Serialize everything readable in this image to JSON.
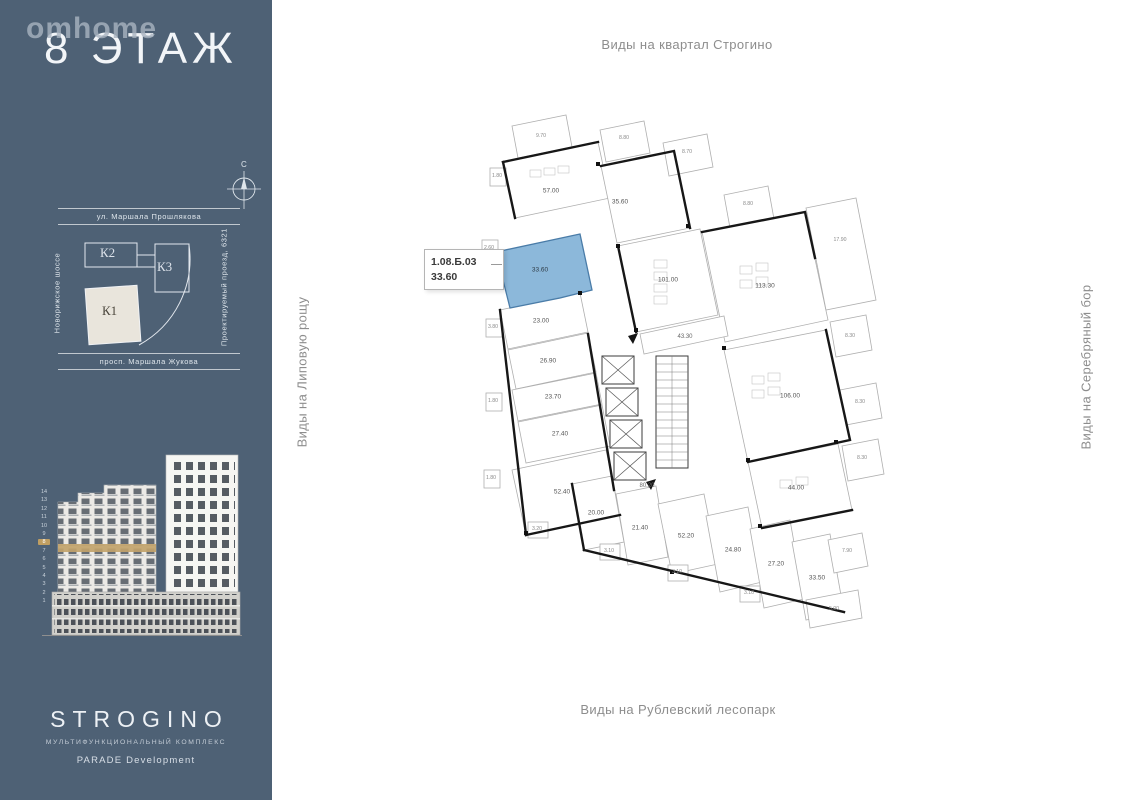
{
  "sidebar": {
    "logo": "omhome",
    "floor_title": "8 ЭТАЖ",
    "compass_north": "С",
    "site_map": {
      "street_top": "ул. Маршала Прошлякова",
      "street_left": "Новорижское шоссе",
      "street_right": "Проектируемый проезд, 6321",
      "street_bottom": "просп. Маршала Жукова",
      "buildings": [
        {
          "label": "К2",
          "highlighted": false
        },
        {
          "label": "К3",
          "highlighted": false
        },
        {
          "label": "К1",
          "highlighted": true
        }
      ]
    },
    "elevation_floors": [
      "14",
      "13",
      "12",
      "11",
      "10",
      "9",
      "8",
      "7",
      "6",
      "5",
      "4",
      "3",
      "2",
      "1"
    ],
    "highlighted_floor": "8",
    "brand": {
      "name": "STROGINO",
      "subtitle": "МУЛЬТИФУНКЦИОНАЛЬНЫЙ КОМПЛЕКС",
      "developer": "PARADE Development"
    }
  },
  "main": {
    "view_labels": {
      "top": "Виды на квартал Строгино",
      "bottom": "Виды на Рублевский лесопарк",
      "left": "Виды на Липовую рощу",
      "right": "Виды на Серебряный бор"
    },
    "callout": {
      "unit_id": "1.08.Б.03",
      "area": "33.60"
    },
    "colors": {
      "highlight": "#7FB0D6",
      "sidebar_bg": "#4E6175",
      "floor_marker": "#BF9E62"
    },
    "plan": {
      "rooms": [
        {
          "label": "57.00",
          "x": 111,
          "y": 101
        },
        {
          "label": "35.60",
          "x": 180,
          "y": 112
        },
        {
          "label": "101.00",
          "x": 228,
          "y": 190
        },
        {
          "label": "113.30",
          "x": 325,
          "y": 196
        },
        {
          "label": "106.00",
          "x": 350,
          "y": 306
        },
        {
          "label": "44.00",
          "x": 356,
          "y": 398
        },
        {
          "label": "33.60",
          "x": 100,
          "y": 180,
          "highlighted": true
        },
        {
          "label": "23.00",
          "x": 101,
          "y": 231
        },
        {
          "label": "26.90",
          "x": 108,
          "y": 271
        },
        {
          "label": "23.70",
          "x": 113,
          "y": 307
        },
        {
          "label": "27.40",
          "x": 120,
          "y": 344
        },
        {
          "label": "52.40",
          "x": 122,
          "y": 402
        },
        {
          "label": "20.00",
          "x": 156,
          "y": 423
        },
        {
          "label": "21.40",
          "x": 200,
          "y": 438
        },
        {
          "label": "52.20",
          "x": 246,
          "y": 446
        },
        {
          "label": "24.80",
          "x": 293,
          "y": 460
        },
        {
          "label": "27.20",
          "x": 336,
          "y": 474
        },
        {
          "label": "33.50",
          "x": 377,
          "y": 488
        }
      ],
      "corridors": [
        {
          "label": "80.20",
          "x": 207,
          "y": 396
        },
        {
          "label": "43.30",
          "x": 245,
          "y": 247
        }
      ],
      "balconies": [
        {
          "label": "9.70",
          "x": 101,
          "y": 46
        },
        {
          "label": "8.80",
          "x": 184,
          "y": 48
        },
        {
          "label": "8.70",
          "x": 247,
          "y": 62
        },
        {
          "label": "8.80",
          "x": 308,
          "y": 114
        },
        {
          "label": "17.90",
          "x": 400,
          "y": 150
        },
        {
          "label": "8.30",
          "x": 410,
          "y": 246
        },
        {
          "label": "8.30",
          "x": 420,
          "y": 312
        },
        {
          "label": "8.30",
          "x": 422,
          "y": 368
        },
        {
          "label": "7.90",
          "x": 407,
          "y": 461
        },
        {
          "label": "5.00",
          "x": 394,
          "y": 519
        },
        {
          "label": "1.80",
          "x": 57,
          "y": 86
        },
        {
          "label": "2.60",
          "x": 49,
          "y": 158
        },
        {
          "label": "3.80",
          "x": 53,
          "y": 237
        },
        {
          "label": "1.80",
          "x": 53,
          "y": 311
        },
        {
          "label": "1.80",
          "x": 51,
          "y": 388
        },
        {
          "label": "3.20",
          "x": 97,
          "y": 439
        },
        {
          "label": "3.10",
          "x": 169,
          "y": 461
        },
        {
          "label": "3.10",
          "x": 237,
          "y": 482
        },
        {
          "label": "3.10",
          "x": 309,
          "y": 503
        }
      ]
    }
  }
}
